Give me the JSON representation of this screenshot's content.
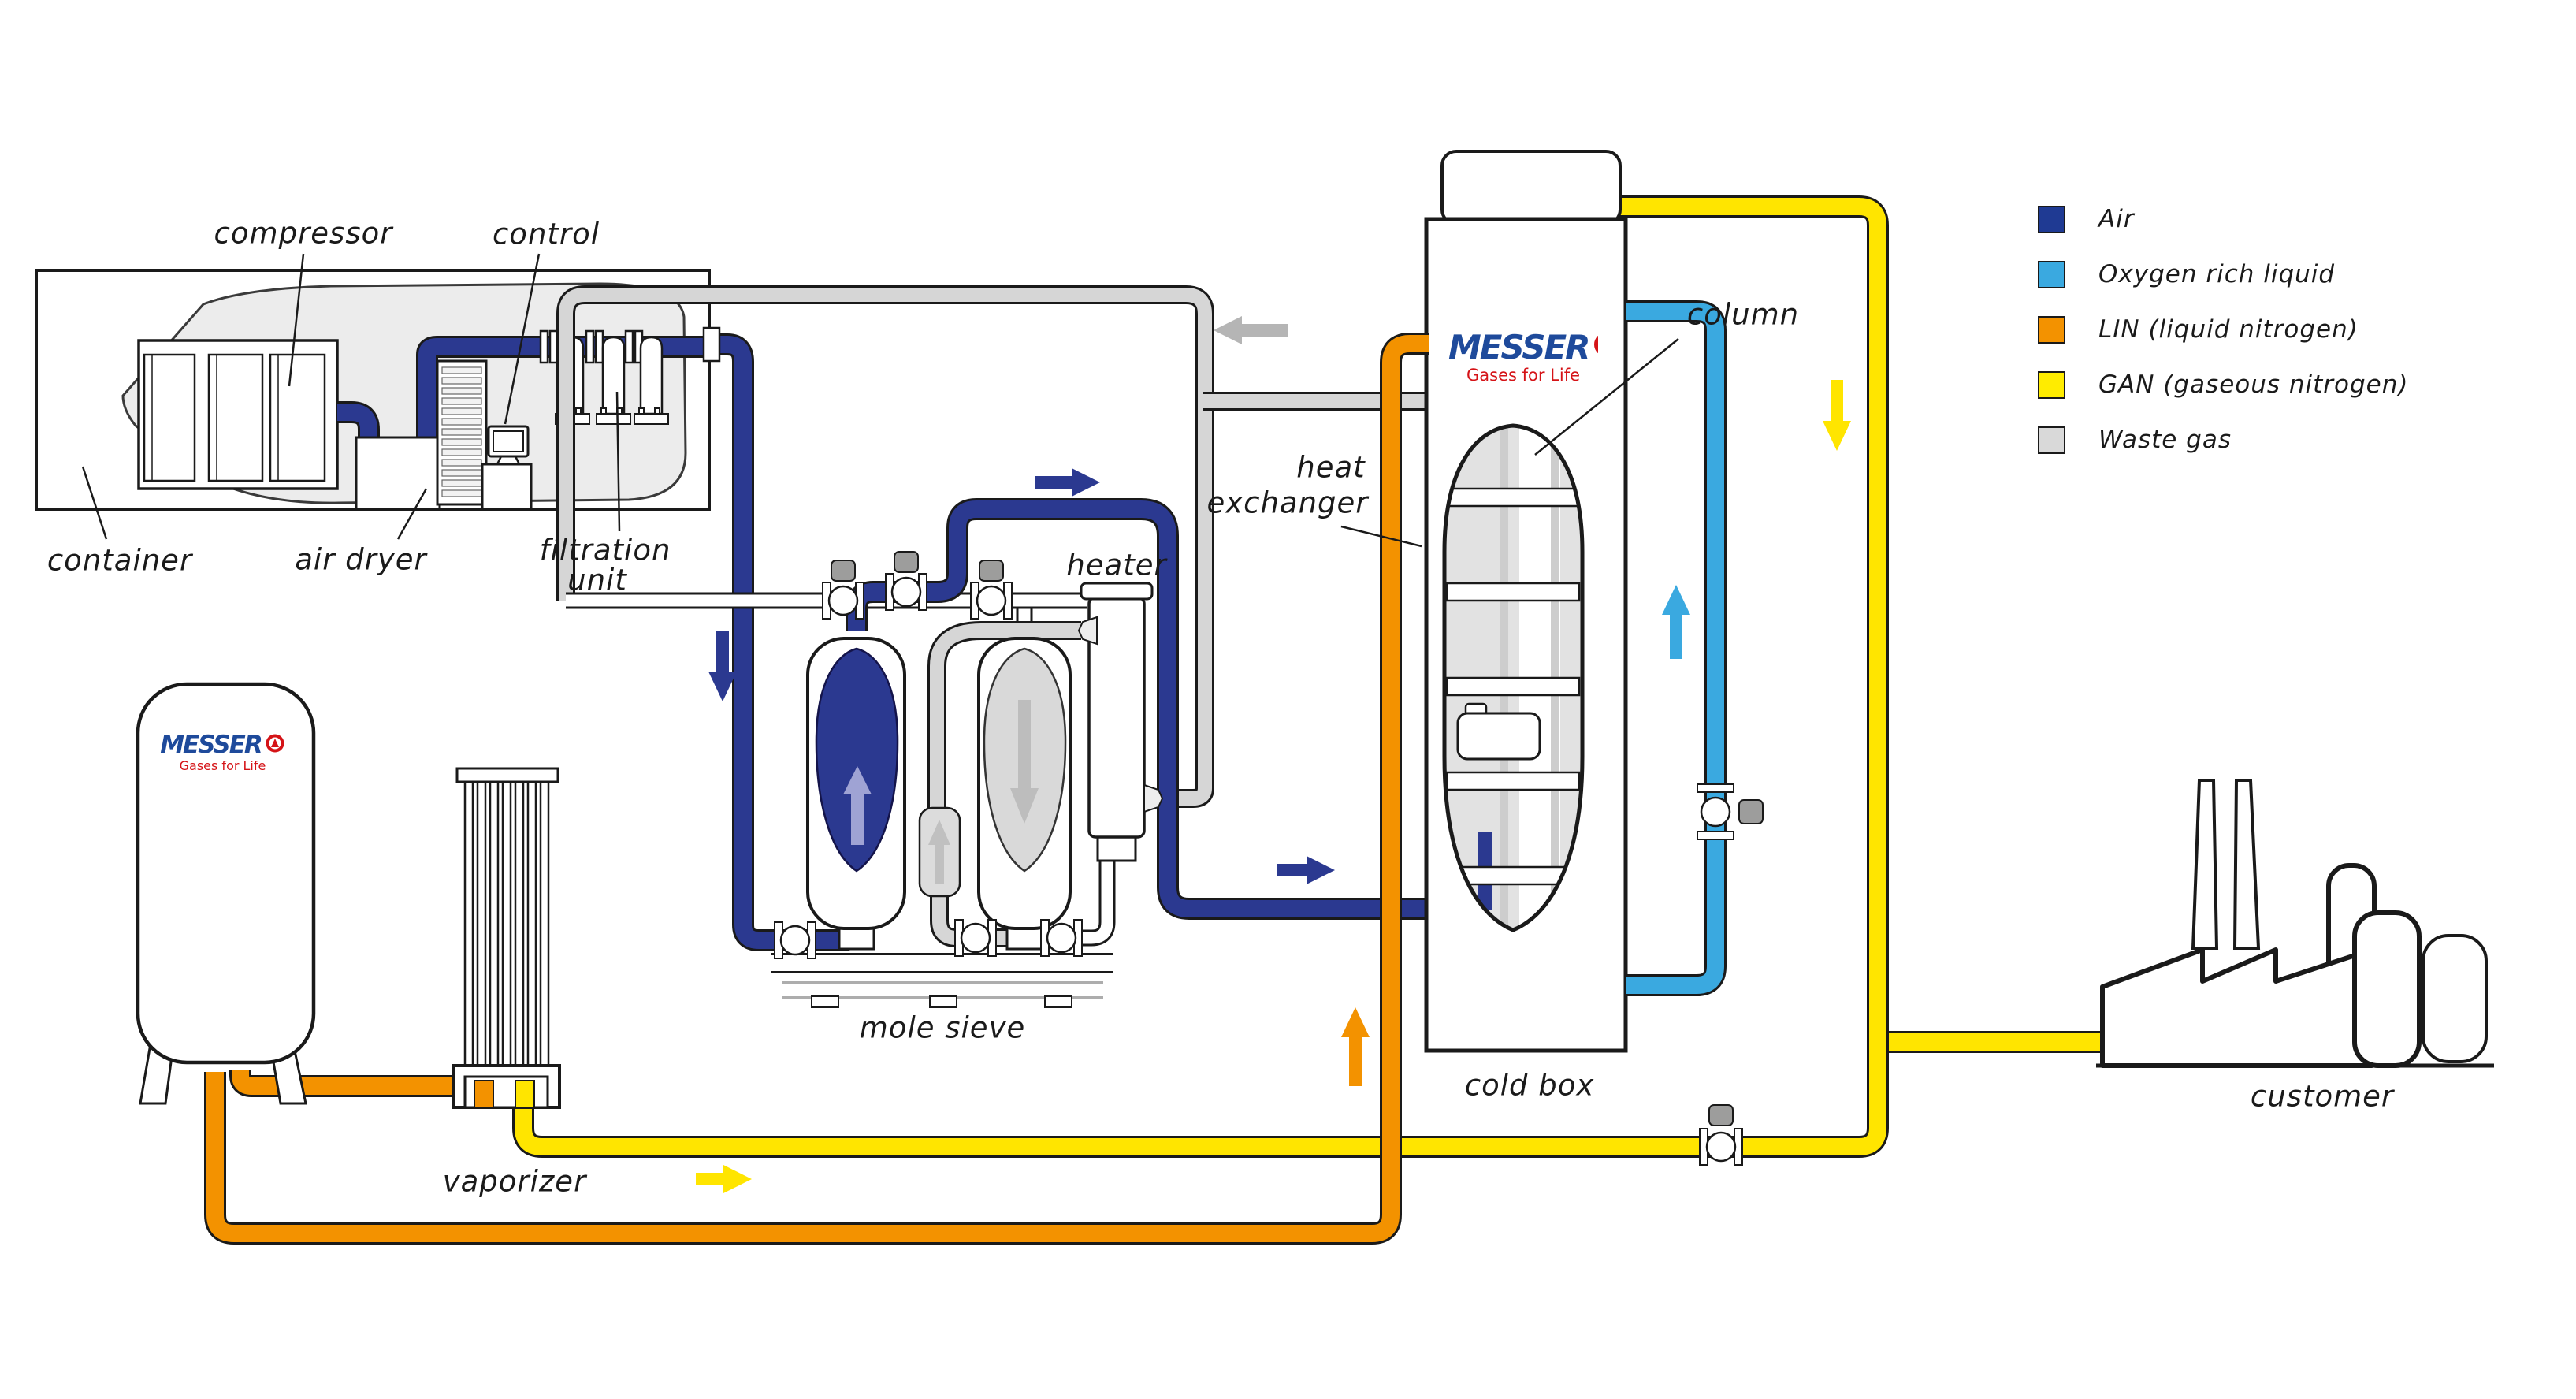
{
  "labels": {
    "compressor": "compressor",
    "control": "control",
    "container": "container",
    "air_dryer": "air dryer",
    "filtration_line1": "filtration",
    "filtration_line2": "unit",
    "mole_sieve": "mole sieve",
    "heater": "heater",
    "heat_exchanger_line1": "heat",
    "heat_exchanger_line2": "exchanger",
    "column": "column",
    "cold_box": "cold box",
    "vaporizer": "vaporizer",
    "customer": "customer"
  },
  "logo": {
    "wordmark": "MESSER",
    "tagline": "Gases for Life"
  },
  "legend": {
    "items": [
      {
        "label": "Air",
        "color": "#1F3A93",
        "color_css": "background:#1F3A93"
      },
      {
        "label": "Oxygen rich liquid",
        "color": "#3AA9E0",
        "color_css": "background:#3AA9E0"
      },
      {
        "label": "LIN (liquid nitrogen)",
        "color": "#F39200",
        "color_css": "background:#F39200"
      },
      {
        "label": "GAN (gaseous nitrogen)",
        "color": "#FFEC00",
        "color_css": "background:#FFEC00"
      },
      {
        "label": "Waste gas",
        "color": "#D9D9D9",
        "color_css": "background:#D9D9D9"
      }
    ]
  },
  "colors": {
    "air_pipe": "#2B3990",
    "oxygen_rich_pipe": "#3AA9E0",
    "lin_pipe": "#F39200",
    "gan_pipe": "#FFE500",
    "waste_pipe": "#D6D6D6",
    "outline": "#1a1a1a"
  }
}
